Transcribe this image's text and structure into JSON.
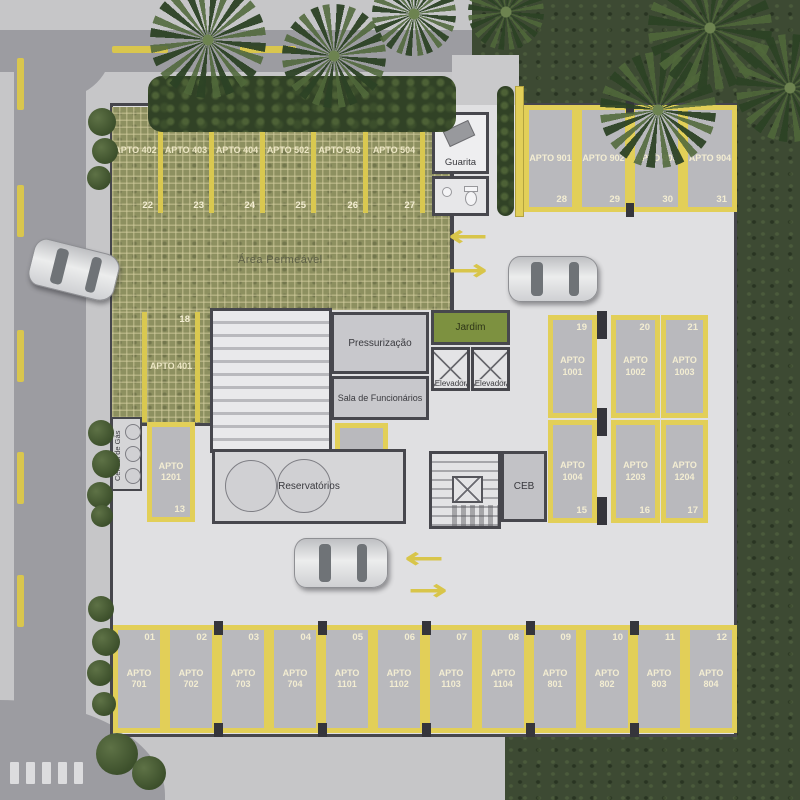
{
  "plan": {
    "area_label": "Área Permeável",
    "rooms": {
      "guarita": "Guarita",
      "pressurizacao": "Pressurização",
      "sala_funcionarios": "Sala de Funcionários",
      "jardim": "Jardim",
      "elevador_1": "Elevador",
      "elevador_2": "Elevador",
      "reservatorios": "Reservatórios",
      "ceb": "CEB",
      "central_gas": "Central de Gás"
    },
    "spots": {
      "green": [
        {
          "num": "22",
          "apto": "APTO 402"
        },
        {
          "num": "23",
          "apto": "APTO 403"
        },
        {
          "num": "24",
          "apto": "APTO 404"
        },
        {
          "num": "25",
          "apto": "APTO 502"
        },
        {
          "num": "26",
          "apto": "APTO 503"
        },
        {
          "num": "27",
          "apto": "APTO 504"
        }
      ],
      "green_single": {
        "num": "18",
        "apto": "APTO 401"
      },
      "top_right": [
        {
          "num": "28",
          "apto": "APTO 901"
        },
        {
          "num": "29",
          "apto": "APTO 902"
        },
        {
          "num": "30",
          "apto": "APTO 903"
        },
        {
          "num": "31",
          "apto": "APTO 904"
        }
      ],
      "right_upper": [
        {
          "num": "19",
          "apto": "APTO 1001"
        },
        {
          "num": "20",
          "apto": "APTO 1002"
        },
        {
          "num": "21",
          "apto": "APTO 1003"
        }
      ],
      "right_lower": [
        {
          "num": "15",
          "apto": "APTO 1004"
        },
        {
          "num": "16",
          "apto": "APTO 1203"
        },
        {
          "num": "17",
          "apto": "APTO 1204"
        }
      ],
      "left": [
        {
          "num": "13",
          "apto": "APTO 1201"
        },
        {
          "num": "14",
          "apto": "APTO 1202"
        }
      ],
      "bottom": [
        {
          "num": "01",
          "apto": "APTO 701"
        },
        {
          "num": "02",
          "apto": "APTO 702"
        },
        {
          "num": "03",
          "apto": "APTO 703"
        },
        {
          "num": "04",
          "apto": "APTO 704"
        },
        {
          "num": "05",
          "apto": "APTO 1101"
        },
        {
          "num": "06",
          "apto": "APTO 1102"
        },
        {
          "num": "07",
          "apto": "APTO 1103"
        },
        {
          "num": "08",
          "apto": "APTO 1104"
        },
        {
          "num": "09",
          "apto": "APTO 801"
        },
        {
          "num": "10",
          "apto": "APTO 802"
        },
        {
          "num": "11",
          "apto": "APTO 803"
        },
        {
          "num": "12",
          "apto": "APTO 804"
        }
      ]
    },
    "icons": {
      "arrow_left": "←",
      "arrow_right": "→"
    },
    "colors": {
      "stripe_yellow": "#e2cf58",
      "permeable_green": "#8d9060",
      "grass": "#3d4a33",
      "asphalt": "#9c9ca1",
      "floor": "#e0e0e2",
      "spot_gray": "#b9b9bd",
      "jardim_green": "#7d9140"
    }
  }
}
